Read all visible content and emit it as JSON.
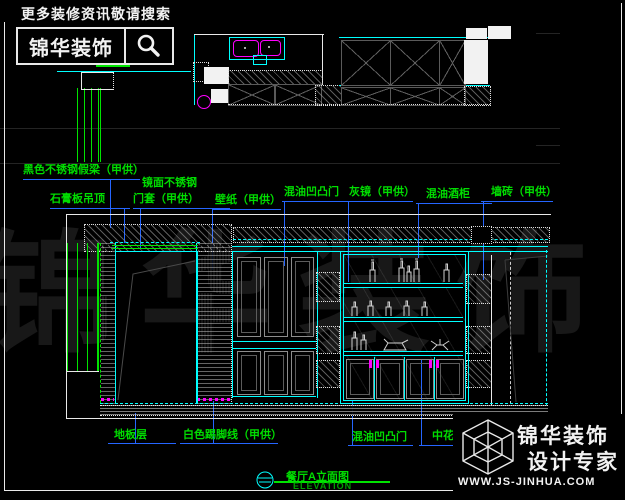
{
  "header": {
    "search_hint": "更多装修资讯敬请搜索",
    "brand": "锦华装饰",
    "search_icon": "magnifier-icon"
  },
  "watermark": {
    "text": "锦华装饰"
  },
  "labels_top": [
    {
      "text": "黑色不锈钢假梁（甲供）"
    },
    {
      "text": "石膏板吊顶"
    },
    {
      "line1": "镜面不锈钢",
      "line2": "门套（甲供）"
    },
    {
      "text": "壁纸（甲供）"
    },
    {
      "text": "混油凹凸门"
    },
    {
      "text": "灰镜（甲供）"
    },
    {
      "text": "混油酒柜"
    },
    {
      "text": "墙砖（甲供）"
    }
  ],
  "labels_bottom": [
    {
      "text": "地板层"
    },
    {
      "text": "白色踢脚线（甲供）"
    },
    {
      "text": "混油凹凸门"
    },
    {
      "text": "中花白理石台面（甲供）"
    }
  ],
  "title_block": {
    "name": "餐厅A立面图",
    "subtitle": "ELEVATION"
  },
  "brand_footer": {
    "line1": "锦华装饰",
    "line2": "设计专家",
    "website": "WWW.JS-JINHUA.COM"
  },
  "colors": {
    "cad_line": "#00ffff",
    "annotation_text": "#00dd00",
    "leader": "#2565ff",
    "fixture": "#ff00ff",
    "drawing": "#ffffff",
    "background": "#000000"
  }
}
